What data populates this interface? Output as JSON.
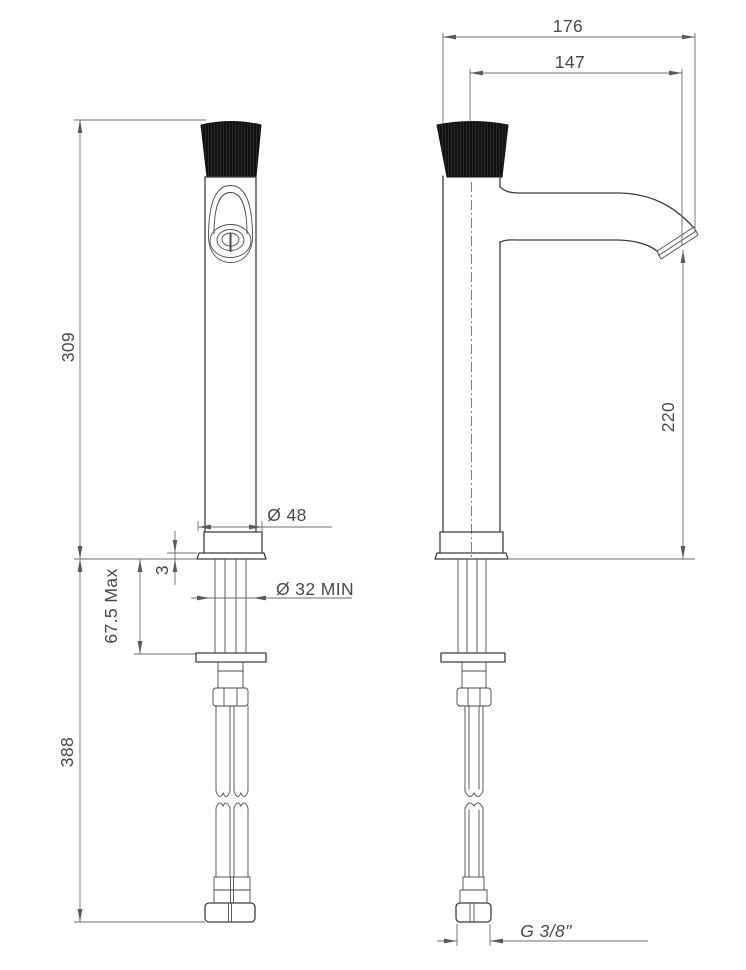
{
  "drawing": {
    "kind": "faucet-dimension-drawing",
    "dimensions": {
      "d176": "176",
      "d147": "147",
      "d309": "309",
      "d220": "220",
      "d388": "388",
      "d675": "67.5 Max",
      "d3": "3",
      "d48": "Ø 48",
      "d32": "Ø 32 MIN",
      "g38": "G 3/8\""
    },
    "colors": {
      "object_line": "#3f3f3f",
      "dimension_line": "#6f6f6f",
      "text": "#4a4a4a",
      "handle_fill": "#111111",
      "background": "#ffffff"
    }
  }
}
